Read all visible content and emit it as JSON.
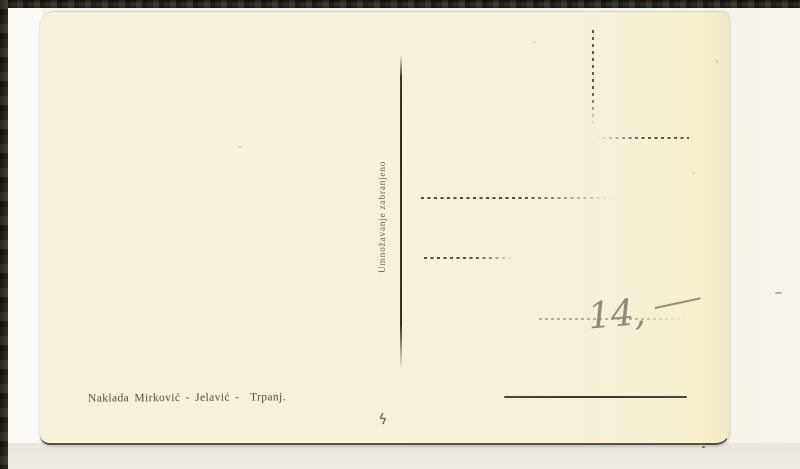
{
  "postcard": {
    "divider_caption": "Umnožavanje zabranjeno",
    "publisher_line": "Naklada Mirković - Jelavić -  Trpanj.",
    "handwriting": {
      "price_number": "14,",
      "price_dash": "—",
      "squiggle_mark": "ϟ"
    },
    "colors": {
      "card_background": "#f5f1da",
      "printed_ink": "#524d3d",
      "pencil": "#8e8a7a",
      "photo_edge_dark": "#26231d",
      "scan_bed": "#f3f1e9"
    }
  }
}
